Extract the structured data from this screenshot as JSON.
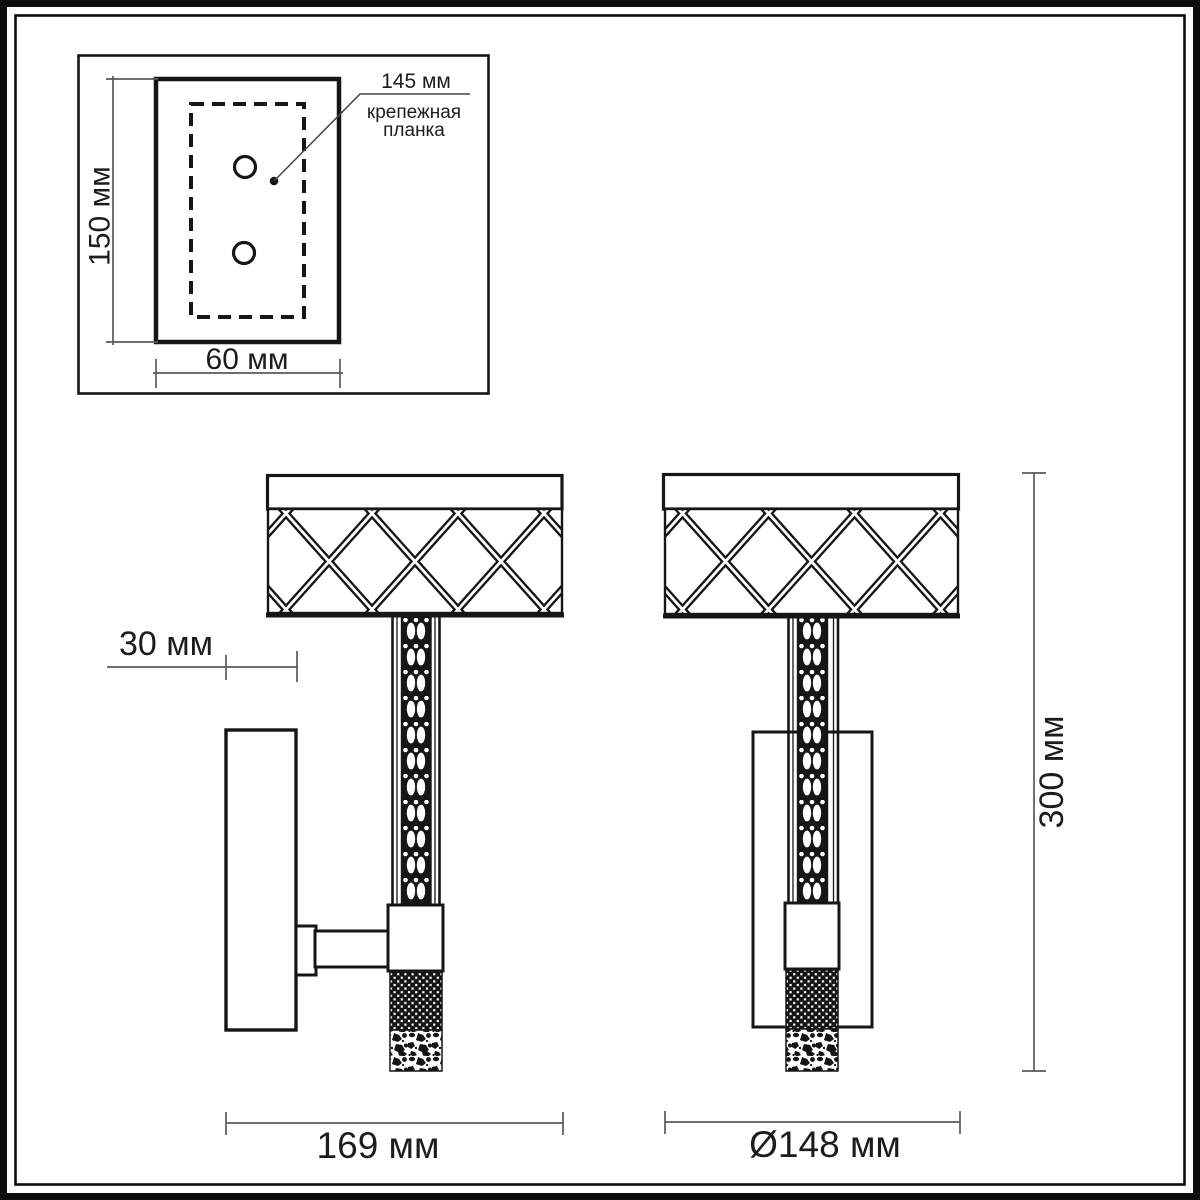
{
  "colors": {
    "ink": "#1a1a1a",
    "dim_line": "#5a5a5a",
    "background": "#ffffff"
  },
  "mounting_detail": {
    "height_label": "150 мм",
    "width_label": "60 мм",
    "callout_value": "145 мм",
    "callout_caption_line1": "крепежная",
    "callout_caption_line2": "планка"
  },
  "side_view": {
    "depth_label": "30 мм",
    "width_label": "169 мм"
  },
  "front_view": {
    "height_label": "300 мм",
    "diameter_label": "Ø148 мм"
  }
}
